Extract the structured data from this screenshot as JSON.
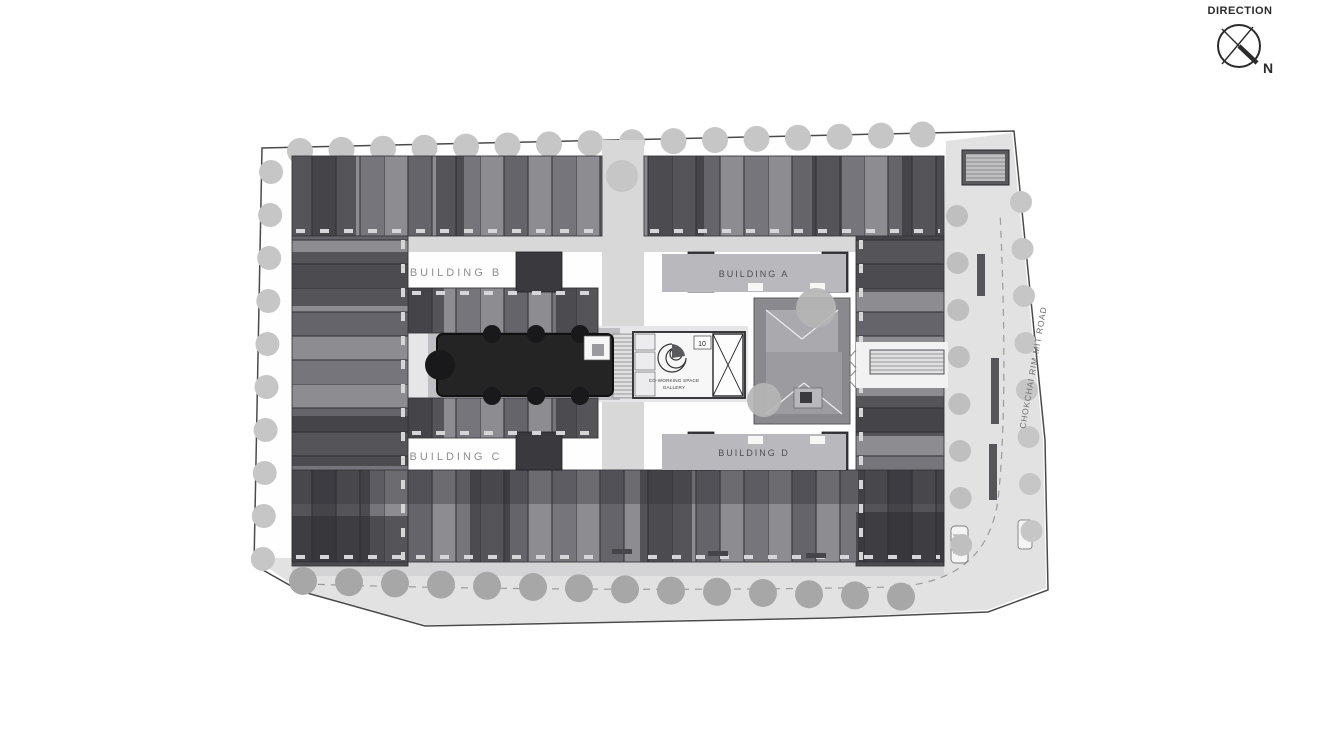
{
  "compass": {
    "title": "DIRECTION",
    "north": "N"
  },
  "buildings": {
    "a": "BUILDING A",
    "b": "BUILDING B",
    "c": "BUILDING C",
    "d": "BUILDING D"
  },
  "facility": {
    "unit_number": "10",
    "label_line1": "CO-WORKING SPACE",
    "label_line2": "GALLERY"
  },
  "road_label": "CHOKCHAI RIM-MIT ROAD",
  "colors": {
    "ink": "#2b2b2b",
    "boundary": "#4a4a4a",
    "road": "#e2e2e3",
    "tree_light": "#c6c6c6",
    "tree_mid": "#a7a7a7",
    "corridor": "#d8d8d8",
    "base": "#e6e6e8",
    "plaza": "#b9b9bd",
    "pool": "#242424",
    "pool_tree": "#19191b",
    "unit_light": "#8d8d91",
    "unit_mid": "#75757b",
    "unit_dark": "#64646a",
    "unit_line": "#3b3b3f",
    "cluster": "#2e2e33",
    "core": "#3a3a3e",
    "label_grey": "#8f8f8f",
    "label_dark": "#4e4e52"
  }
}
